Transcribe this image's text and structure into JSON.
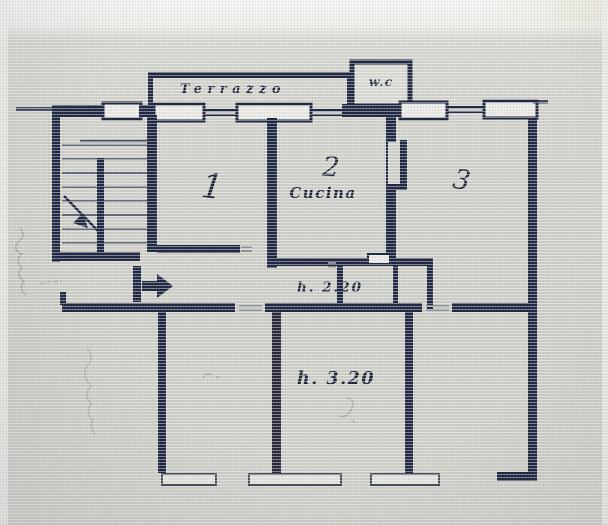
{
  "plan": {
    "labels": {
      "terrace": "Terrazzo",
      "wc": "w.c",
      "room1": "1",
      "room2": "2",
      "kitchen": "Cucina",
      "room3": "3",
      "height_corridor": "h. 2.20",
      "height_room": "h. 3.20"
    },
    "colors": {
      "ink": "#1e2540",
      "paper": "#cfd0ca",
      "paper_light": "#eceeea",
      "window_fill": "#e8e9e4",
      "sill_stroke": "#454b58"
    }
  }
}
